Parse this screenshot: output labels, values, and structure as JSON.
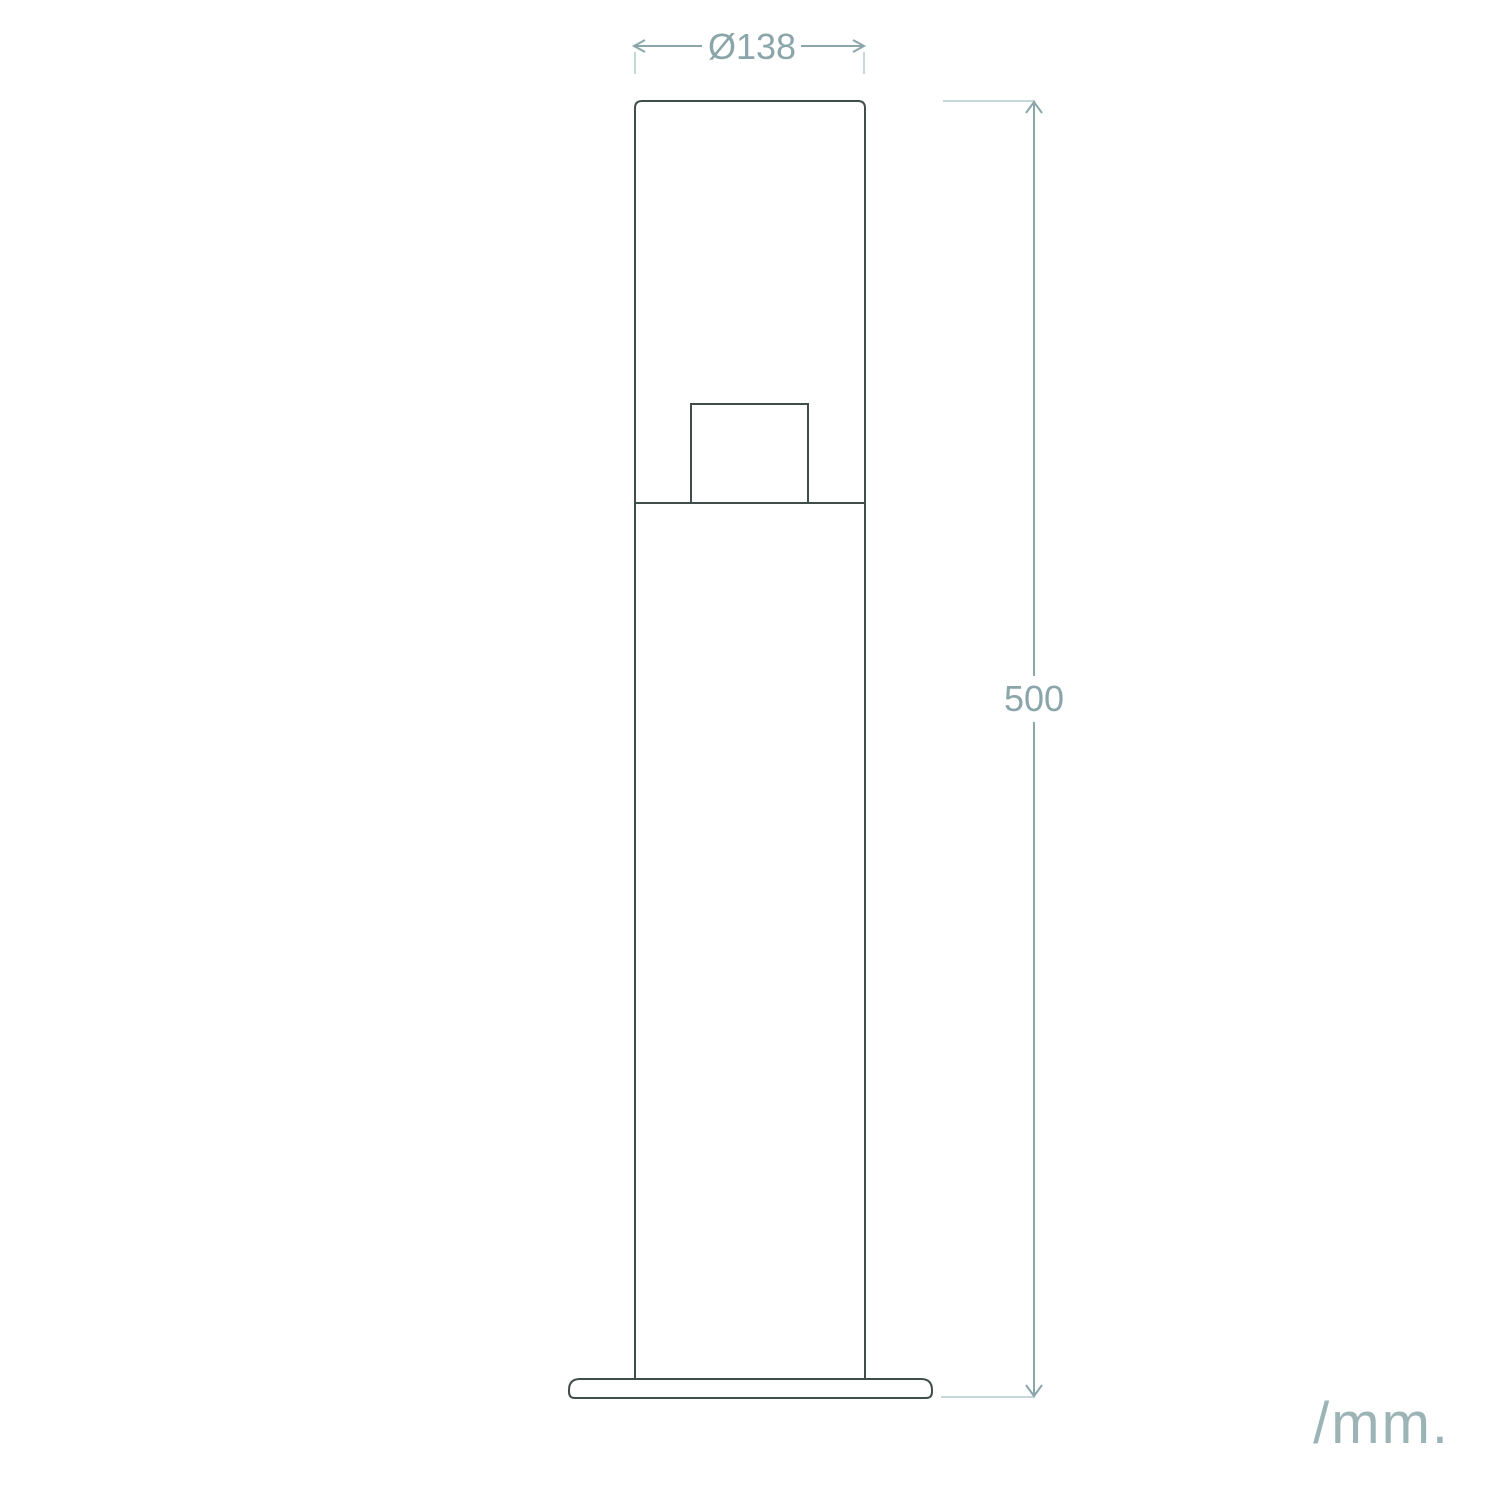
{
  "drawing": {
    "type": "technical-elevation",
    "dimensions": {
      "diameter_label": "Ø138",
      "diameter_value_mm": 138,
      "height_label": "500",
      "height_value_mm": 500
    },
    "units_label": "/mm.",
    "colors": {
      "outline": "#3f4d4b",
      "dimension": "#8ba6aa",
      "extension": "#c7d8da",
      "units_text": "#9db4b7",
      "background": "#ffffff"
    }
  }
}
